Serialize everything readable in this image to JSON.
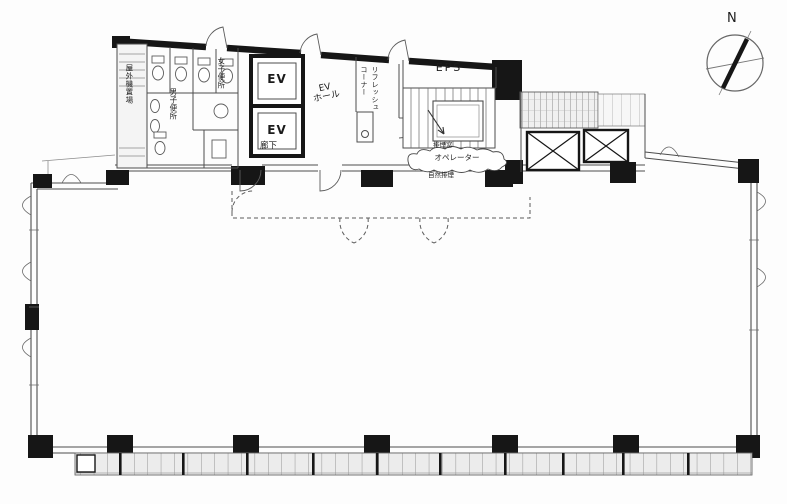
{
  "compass": {
    "north_label": "N"
  },
  "rooms": {
    "outdoor_unit_area": "屋外機置場",
    "womens_toilet": "女子便所",
    "mens_toilet": "男子便所",
    "elevator_1": "EV",
    "elevator_2": "EV",
    "ev_hall_line1": "EV",
    "ev_hall_line2": "ホール",
    "corridor": "廊下",
    "refresh_corner_line1": "リフレッシュ",
    "refresh_corner_line2": "コーナー",
    "eps": "EPS"
  },
  "annotations": {
    "smoke_vent": "排煙窓",
    "operator_note": "オペレーター",
    "natural_vent": "自然排煙"
  },
  "colors": {
    "wall": "#161616",
    "thin_line": "#555555",
    "hatch_fill": "#ededed"
  }
}
